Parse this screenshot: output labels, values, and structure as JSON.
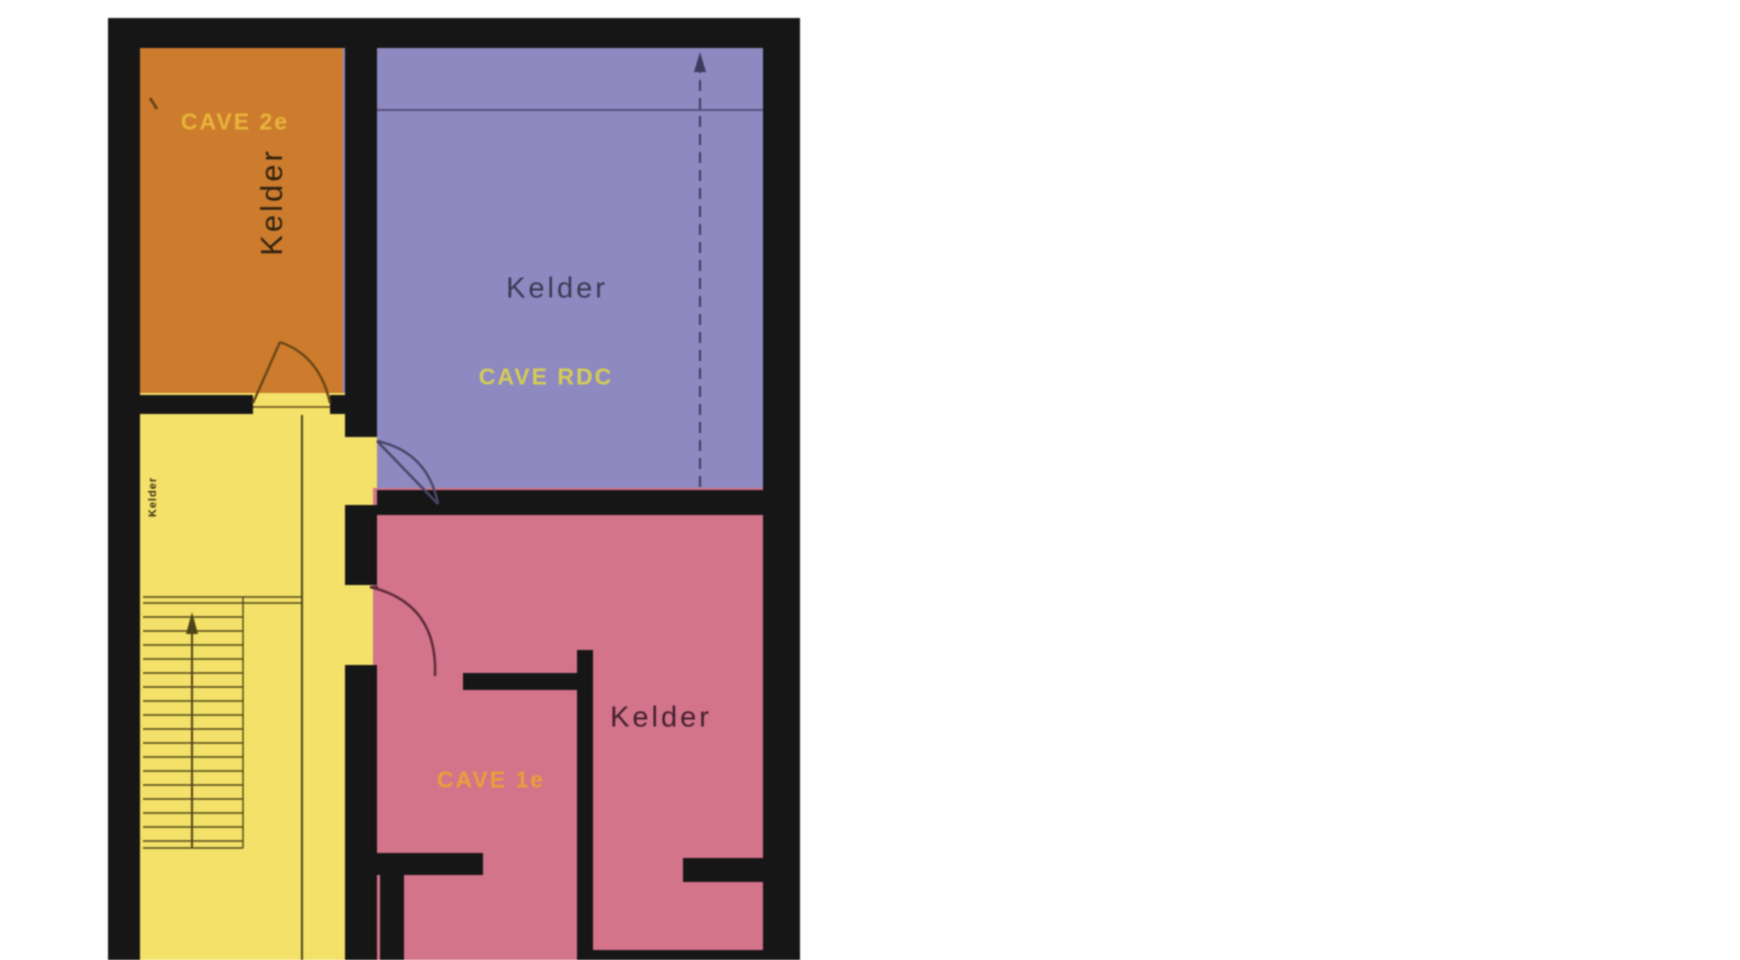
{
  "plan_title": "basement floor plan",
  "rooms": {
    "cave_2e": {
      "name_nl": "Kelder",
      "name_fr": "CAVE 2e"
    },
    "cave_rdc": {
      "name_nl": "Kelder",
      "name_fr": "CAVE RDC"
    },
    "cave_1e": {
      "name_nl": "Kelder",
      "name_fr": "CAVE 1e"
    },
    "hallway": {
      "name_nl": "Kelder"
    }
  },
  "colors": {
    "wall": "#161616",
    "room_cave_2e": "#cd7c2e",
    "room_cave_rdc": "#8e89c0",
    "room_hallway": "#f3e169",
    "room_cave_1e": "#d3748a",
    "label_cave_2e": "#e8b43a",
    "label_cave_rdc": "#d5cc58",
    "label_cave_1e": "#e9a039",
    "kelder_on_orange": "#30210f",
    "kelder_on_purple": "#3b3856",
    "kelder_on_pink": "#43202e",
    "kelder_small": "#3a3012",
    "stair_line": "#4f4418",
    "purple_line": "#55517f",
    "dash_line": "#3e3a5e",
    "door_orange": "#6b4616",
    "door_purple": "#4a4668",
    "door_pink": "#5e2a3a"
  }
}
